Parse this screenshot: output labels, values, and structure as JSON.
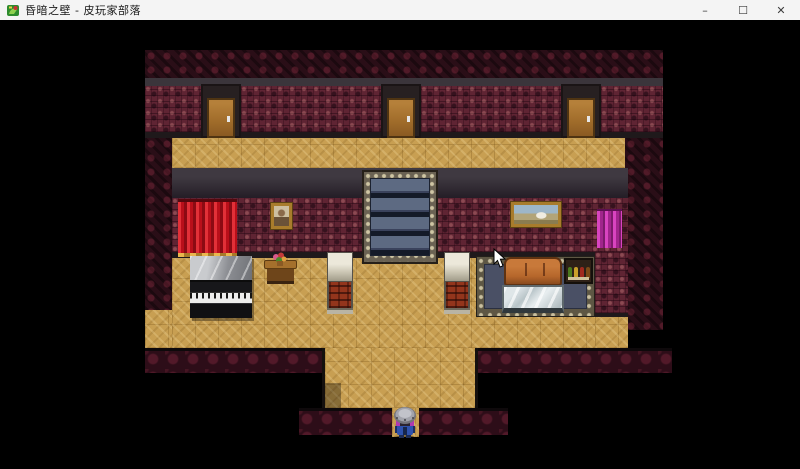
{
  "window": {
    "title": "昏暗之壁 - 皮玩家部落",
    "controls": {
      "minimize": "–",
      "maximize": "☐",
      "close": "✕"
    }
  },
  "game": {
    "scene": "dim-tavern-interior",
    "objects": [
      "door-left",
      "door-middle",
      "door-right",
      "staircase-with-runner",
      "red-curtain",
      "portrait-painting",
      "landscape-painting",
      "magenta-curtain",
      "upright-piano",
      "flower-table",
      "brick-pillar-left",
      "brick-pillar-right",
      "ornate-rug",
      "leather-couch",
      "glass-coffee-table",
      "bottle-shelf",
      "player-character",
      "mouse-cursor"
    ],
    "player": {
      "description": "sprite with round metal helmet and blue outfit",
      "location": "bottom-center corridor"
    },
    "colors": {
      "floor_parquet": "#c89f52",
      "wall_damask": "#5f2433",
      "wall_dark": "#2a0e17",
      "curtain_red": "#c1121f",
      "curtain_magenta": "#c837ae",
      "couch_leather": "#b5662b",
      "stair_runner": "#5d6a82",
      "door_wood": "#a06c2a"
    }
  }
}
